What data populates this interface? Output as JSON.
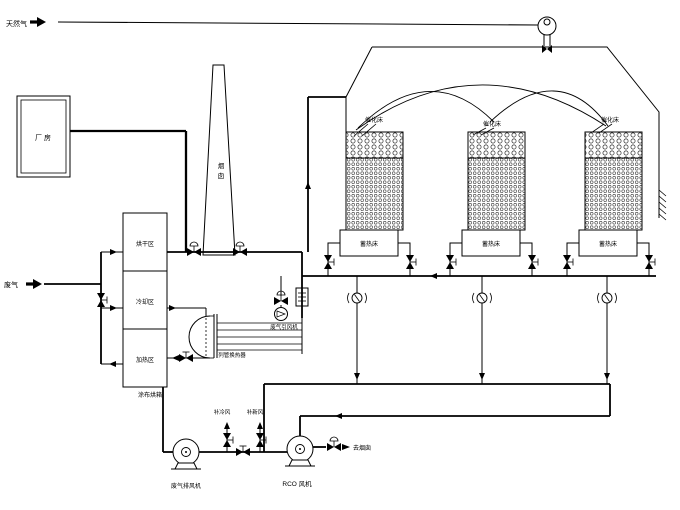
{
  "labels": {
    "natural_gas": "天然气",
    "waste_gas": "废气",
    "factory": "厂 房",
    "chimney": [
      "烟",
      "囱"
    ],
    "oven": {
      "zones": [
        "烘干区",
        "冷却区",
        "加热区"
      ],
      "name": "涂布烘箱"
    },
    "heat_exchanger": "列管换热器",
    "induced_fan": "废气引风机",
    "towers": [
      {
        "top": "催化床",
        "bottom": "蓄热床"
      },
      {
        "top": "催化床",
        "bottom": "蓄热床"
      },
      {
        "top": "催化床",
        "bottom": "蓄热床"
      }
    ],
    "makeup_cold_air": "补冷风",
    "makeup_fresh_air": "补新风",
    "exhaust_fan": "废气排风机",
    "rco_fan": "RCO 风机",
    "to_chimney": "去烟囱"
  },
  "colors": {
    "line": "#000000",
    "background": "#ffffff"
  }
}
